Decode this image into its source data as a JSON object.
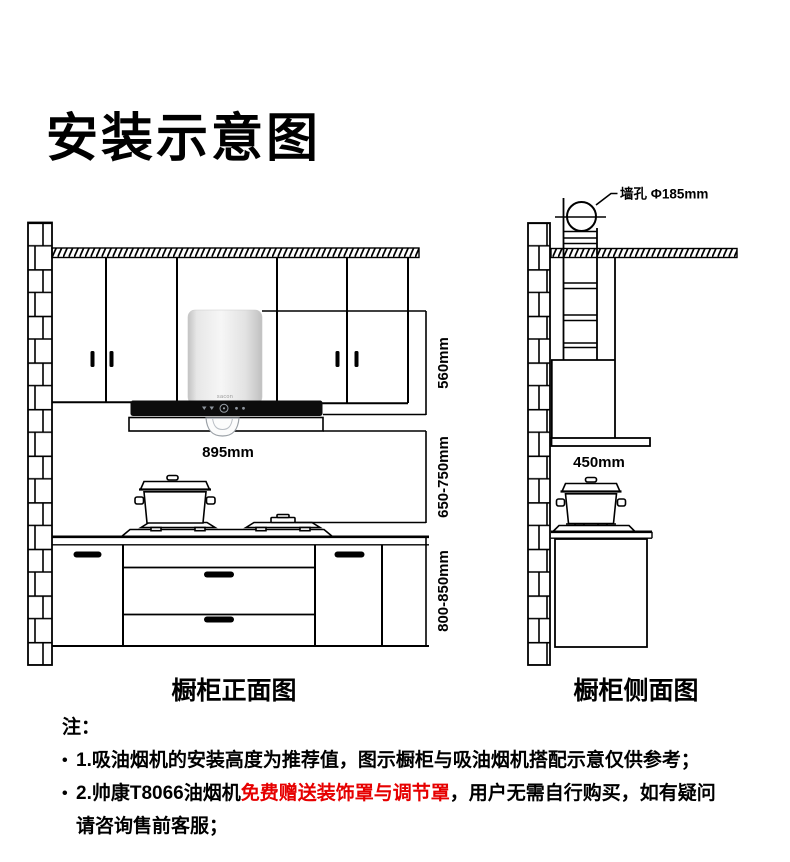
{
  "title": "安装示意图",
  "front_view": {
    "caption": "橱柜正面图",
    "hood_logo": "sacon",
    "dims": {
      "hood_width": "895mm",
      "chimney_height": "560mm",
      "hood_to_cooktop": "650-750mm",
      "counter_height": "800-850mm"
    }
  },
  "side_view": {
    "caption": "橱柜侧面图",
    "wall_hole_label": "墙孔 Φ185mm",
    "dims": {
      "hood_depth": "450mm"
    }
  },
  "notes": {
    "heading": "注：",
    "items": [
      {
        "bullet": "•",
        "text": "1.吸油烟机的安装高度为推荐值，图示橱柜与吸油烟机搭配示意仅供参考；"
      },
      {
        "bullet": "•",
        "prefix": "2.帅康T8066油烟机",
        "highlight": "免费赠送装饰罩与调节罩",
        "suffix": "，用户无需自行购买，如有疑问",
        "line2": "请咨询售前客服；"
      }
    ]
  },
  "colors": {
    "highlight": "#e60000",
    "line": "#000000"
  }
}
